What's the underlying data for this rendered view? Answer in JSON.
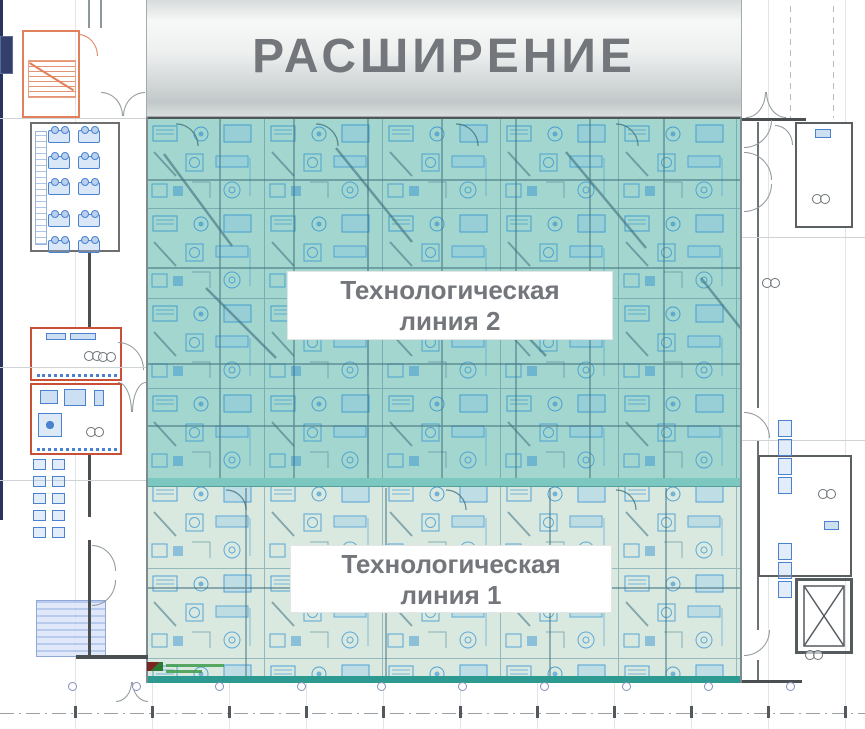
{
  "banner": {
    "title": "РАСШИРЕНИЕ"
  },
  "plan": {
    "type": "factory-floor-plan",
    "zones": [
      {
        "id": "tech-line-2",
        "label_line1": "Технологическая",
        "label_line2": "линия 2",
        "overlay_color": "#a3d6cf"
      },
      {
        "id": "tech-line-1",
        "label_line1": "Технологическая",
        "label_line2": "линия 1",
        "overlay_color": "#d9e9e0"
      }
    ]
  },
  "palette": {
    "banner_text": "#73767a",
    "label_text": "#73767a",
    "blueprint_blue": "#2e8fd0",
    "wall_gray": "#5a6064",
    "stair_orange": "#e0815c",
    "room_outline_orange": "#c94f38",
    "zone_divider_teal": "#7cc8c1",
    "hall_bottom_teal": "#2d9a92",
    "left_edge_navy": "#27355f",
    "column_marker_blue": "#8590bd"
  }
}
